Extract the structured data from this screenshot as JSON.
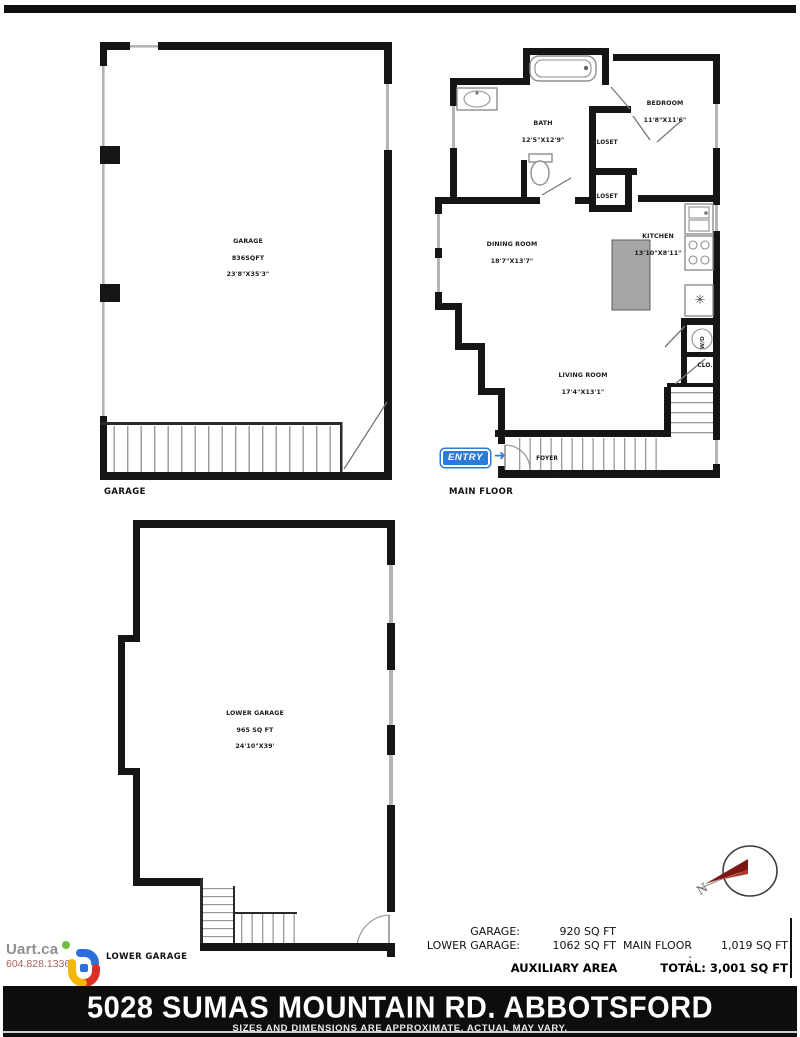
{
  "branding": {
    "company": "Uart.ca",
    "phone": "604.828.1336"
  },
  "compass": {
    "north": "N"
  },
  "icons": {
    "snowflake": "✳",
    "entry_arrow": "➜"
  },
  "plans": {
    "garage": {
      "caption": "GARAGE",
      "label": {
        "name": "GARAGE",
        "area": "836SQFT",
        "dims": "23'8\"X35'3\""
      }
    },
    "main_floor": {
      "caption": "MAIN FLOOR",
      "entry": "ENTRY",
      "rooms": {
        "bath": {
          "name": "BATH",
          "dims": "12'5\"X12'9\""
        },
        "bedroom": {
          "name": "BEDROOM",
          "dims": "11'8\"X11'6\""
        },
        "closet_top": {
          "name": "CLOSET"
        },
        "closet_bottom": {
          "name": "CLOSET"
        },
        "dining": {
          "name": "DINING ROOM",
          "dims": "18'7\"X13'7\""
        },
        "kitchen": {
          "name": "KITCHEN",
          "dims": "13'10\"X8'11\""
        },
        "living": {
          "name": "LIVING ROOM",
          "dims": "17'4\"X13'1\""
        },
        "foyer": {
          "name": "FOYER",
          "dims": "19'5\"X5'5\""
        },
        "closet_side": {
          "name": "CLO."
        },
        "laundry": {
          "name": "W/D"
        }
      }
    },
    "lower_garage": {
      "caption": "LOWER GARAGE",
      "label": {
        "name": "LOWER GARAGE",
        "area": "965 SQ FT",
        "dims": "24'10\"X39'"
      }
    }
  },
  "summary": {
    "rows": [
      {
        "label": "GARAGE:",
        "value": "920 SQ FT"
      },
      {
        "label": "LOWER GARAGE:",
        "value": "1062 SQ FT"
      },
      {
        "label": "MAIN FLOOR :",
        "value": "1,019 SQ FT"
      }
    ],
    "auxiliary": "AUXILIARY AREA",
    "total_label": "TOTAL:",
    "total_value": "3,001 SQ FT"
  },
  "footer": {
    "address": "5028 SUMAS MOUNTAIN RD, ABBOTSFORD",
    "disclaimer": "SIZES AND DIMENSIONS ARE APPROXIMATE, ACTUAL MAY VARY."
  },
  "colors": {
    "wall": "#151515",
    "entry_badge": "#2b7bd7",
    "needle": "#8c1d18",
    "logo_green": "#6fbe44",
    "logo_blue": "#2a6fdb",
    "logo_red": "#d93025",
    "logo_yellow": "#f2b705"
  }
}
